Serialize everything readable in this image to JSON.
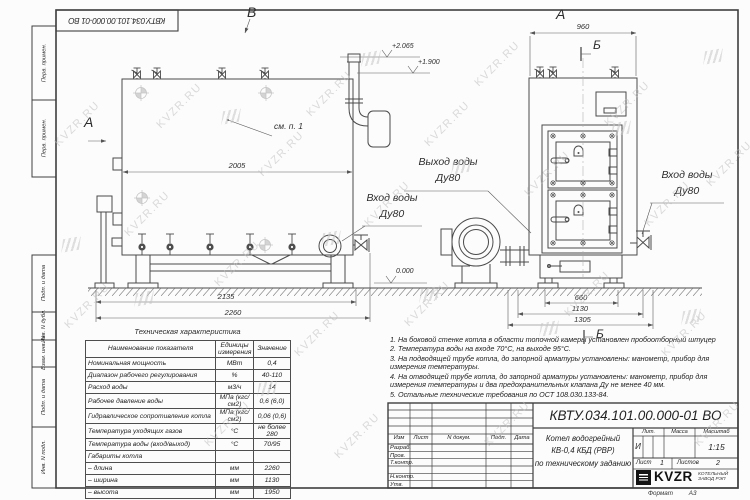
{
  "doc": {
    "number": "КВТУ.034.101.00.000-01 ВО",
    "format_label": "Формат",
    "format_value": "А3"
  },
  "watermark": {
    "text": "KVZR.RU"
  },
  "margin": {
    "labels": [
      "Перв. примен.",
      "Перв. примен.",
      "Подп. и дата",
      "Инв. N дубл.",
      "Взам. инв. N",
      "Подп. и дата",
      "Инв. N подл."
    ]
  },
  "views": {
    "left": {
      "label_a": "А",
      "label_b": "В",
      "see_note": "см. п. 1",
      "dim_width_top": "2005",
      "dim_base": "2135",
      "dim_overall": "2260",
      "elev_top": "+2.065",
      "elev_mid": "+1.900",
      "elev_zero": "0.000",
      "inlet_line1": "Вход воды",
      "inlet_line2": "Ду80"
    },
    "right": {
      "label_a": "А",
      "label_b_top": "Б",
      "label_b_bottom": "Б",
      "dim_top": "960",
      "dim_base": "660",
      "dim_mid": "1130",
      "dim_overall": "1305",
      "outlet_line1": "Выход воды",
      "outlet_line2": "Ду80",
      "inlet_line1": "Вход воды",
      "inlet_line2": "Ду80"
    }
  },
  "spec_table": {
    "title": "Техническая характеристика",
    "headers": [
      "Наименование показателя",
      "Единицы измерения",
      "Значение"
    ],
    "rows": [
      [
        "Номинальная мощность",
        "МВт",
        "0,4"
      ],
      [
        "Диапазон рабочего регулирования",
        "%",
        "40-110"
      ],
      [
        "Расход воды",
        "м3/ч",
        "14"
      ],
      [
        "Рабочее давление воды",
        "МПа (кгс/см2)",
        "0,6 (6,0)"
      ],
      [
        "Гидравлическое сопротивление котла",
        "МПа (кгс/см2)",
        "0,06 (0,6)"
      ],
      [
        "Температура уходящих газов",
        "°С",
        "не более 280"
      ],
      [
        "Температура воды (вход/выход)",
        "°С",
        "70/95"
      ],
      [
        "Габариты котла",
        "",
        ""
      ],
      [
        "– длина",
        "мм",
        "2260"
      ],
      [
        "– ширина",
        "мм",
        "1130"
      ],
      [
        "– высота",
        "мм",
        "1950"
      ]
    ]
  },
  "notes": [
    "1. На боковой стенке котла в области топочной камеры установлен пробоотборный штуцер",
    "2. Температура воды на входе 70°С, на выходе 95°С.",
    "3. На подводящей трубе котла, до запорной арматуры установлены: манометр, прибор для измерения температуры.",
    "4. На отводящей трубе котла, до запорной арматуры установлены: манометр, прибор для измерения температуры и два предохранительных клапана Ду не менее 40 мм.",
    "5. Остальные технические требования по ОСТ 108.030.133-84."
  ],
  "title_block": {
    "doc_number": "КВТУ.034.101.00.000-01 ВО",
    "product_line1": "Котел водогрейный",
    "product_line2": "КВ-0,4  КБД  (РВР)",
    "product_line3": "по техническому заданию",
    "cols": [
      "Изм",
      "Лист",
      "N докум.",
      "Подп.",
      "Дата"
    ],
    "rows": [
      "Разраб.",
      "Пров.",
      "Т.контр.",
      "Н.контр.",
      "Утв."
    ],
    "lit_label": "Лит.",
    "mass_label": "Масса",
    "scale_label": "Масштаб",
    "lit_value": "И",
    "scale_value": "1:15",
    "sheet_label": "Лист",
    "sheet_value": "1",
    "sheets_label": "Листов",
    "sheets_value": "2",
    "brand": "KVZR",
    "brand_line1": "КОТЕЛЬНЫЙ",
    "brand_line2": "ЗАВОД РЭП"
  }
}
